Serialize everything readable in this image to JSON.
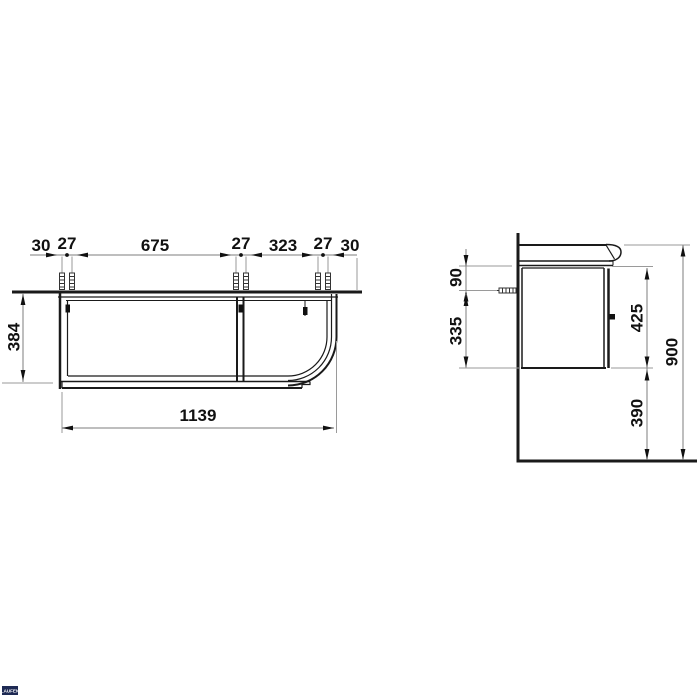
{
  "front_view": {
    "top_dimensions": [
      "30",
      "27",
      "675",
      "27",
      "323",
      "27",
      "30"
    ],
    "height_dim": "384",
    "width_dim": "1139"
  },
  "side_view": {
    "cabinet_top_to_screw": "90",
    "screw_to_cabinet_bottom": "335",
    "cabinet_height": "425",
    "cabinet_bottom_to_floor": "390",
    "overall_height": "900"
  },
  "logo": {
    "text": "LAUFEN"
  },
  "colors": {
    "object_line": "#1a1a1a",
    "dimension_line": "#7d7d7d",
    "extension_line": "#9a9a9a",
    "text": "#111111",
    "background": "#ffffff",
    "logo_background": "#1e2a54"
  }
}
